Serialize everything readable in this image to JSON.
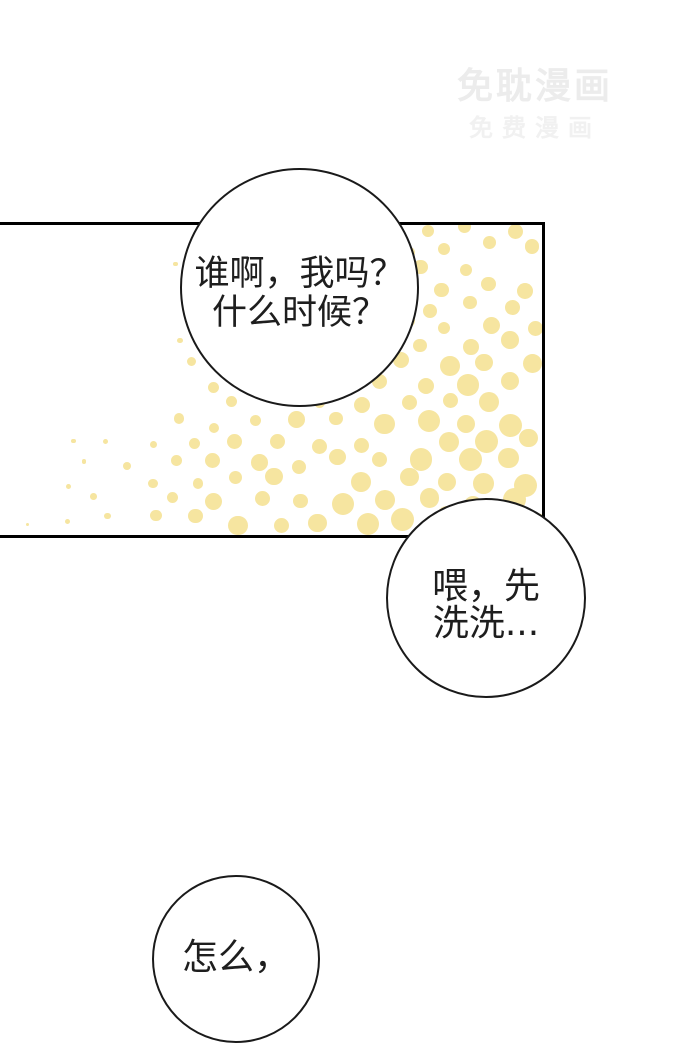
{
  "watermark": {
    "title": "免耽漫画",
    "subtitle": "免费漫画"
  },
  "panel": {
    "halftone_color": "#f6e5a0"
  },
  "bubbles": [
    {
      "lines": [
        "谁啊，我吗？",
        "什么时候？"
      ]
    },
    {
      "lines": [
        "喂，先",
        "洗洗..."
      ]
    },
    {
      "lines": [
        "怎么，"
      ]
    }
  ]
}
